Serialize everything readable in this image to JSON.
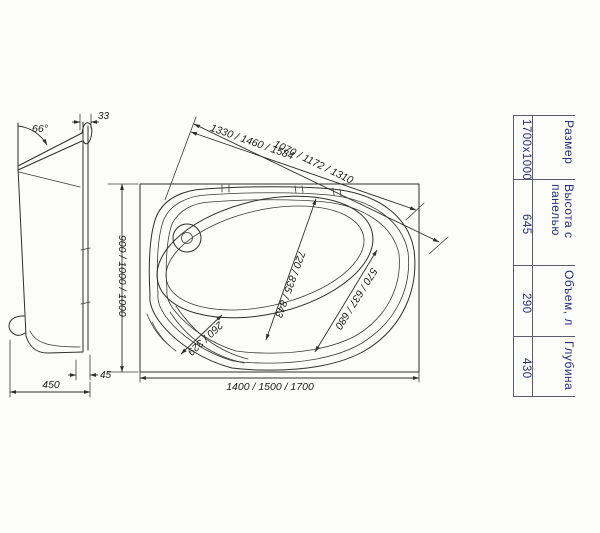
{
  "drawing_colors": {
    "line": "#2e2e2e",
    "table_text": "#22307f",
    "background": "#fcfcfa"
  },
  "side_view": {
    "dim_angle": "66°",
    "dim_rim_overhang": "33",
    "dim_bottom_gap": "45",
    "dim_depth_width": "450"
  },
  "plan_view": {
    "dim_top_inner": "1330 / 1460 / 1584",
    "dim_top_outer": "1070 / 1172 / 1310",
    "dim_diag_width": "720 / 835 / 843",
    "dim_diag_inner": "570 / 637 / 680",
    "dim_seat": "260 / 329",
    "dim_side": "900 / 1000 / 1000",
    "dim_length": "1400 / 1500 / 1700"
  },
  "spec_table": {
    "columns": [
      {
        "header": "Размер",
        "value": "1700x1000"
      },
      {
        "header": "Высота с панелью",
        "value": "645"
      },
      {
        "header": "Объем, л",
        "value": "290"
      },
      {
        "header": "Глубина",
        "value": "430"
      }
    ]
  }
}
